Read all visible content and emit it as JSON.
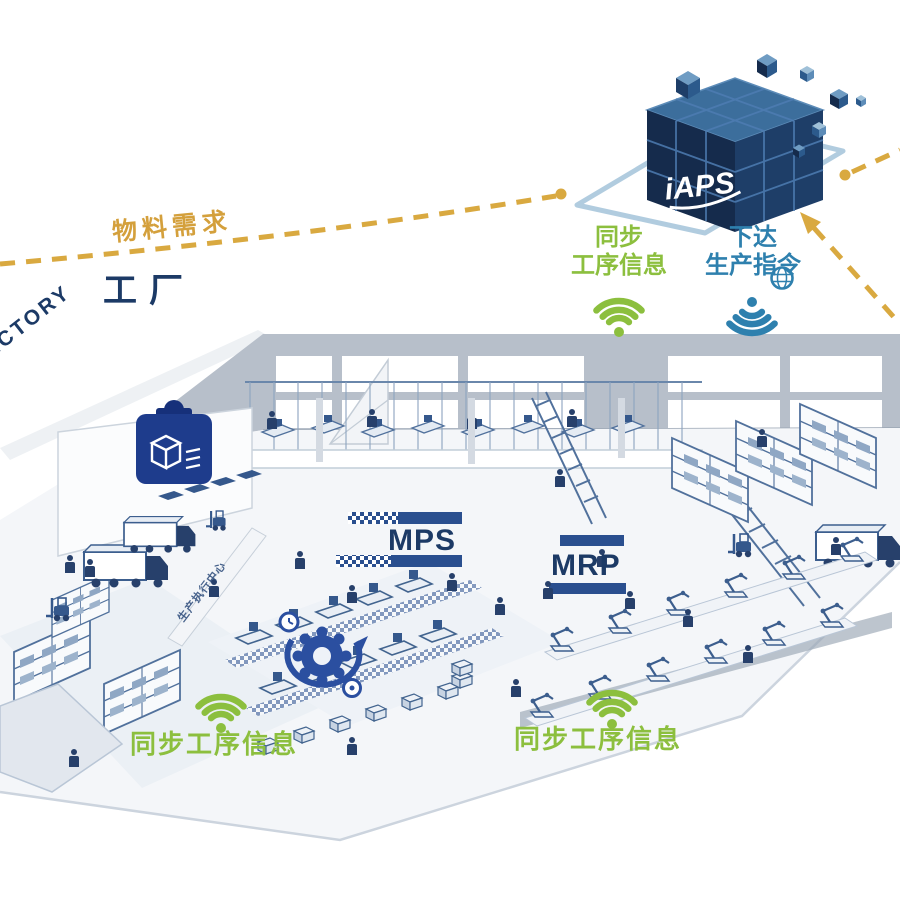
{
  "diagram": {
    "cube_logo": "iAPS",
    "material_demand": "物料需求",
    "factory_cn": "工厂",
    "factory_en": "FACTORY",
    "sync_process_top": {
      "line1": "同步",
      "line2": "工序信息"
    },
    "issue_instruction": {
      "line1": "下达",
      "line2": "生产指令"
    },
    "mps": "MPS",
    "mrp": "MRP",
    "sync_process_bottom_left": "同步工序信息",
    "sync_process_bottom_right": "同步工序信息",
    "wall_zone_text": "生产执行中心"
  },
  "icons": [
    "iaps-cube",
    "wifi-up-icon",
    "wifi-down-icon",
    "clipboard-box-icon",
    "gear-cycle-icon",
    "globe-icon",
    "dashed-arrow",
    "robot-arm",
    "shelf-rack",
    "truck",
    "forklift",
    "worker"
  ],
  "colors": {
    "gold": "#D4A03C",
    "green": "#8CBF3E",
    "blue": "#2E80AE",
    "navy_text": "#1C3A66",
    "royal_blue": "#1E3C8C",
    "bar_navy": "#2A4F8F",
    "wall_gray": "#B7BFCA",
    "line_blue": "#51719C",
    "cube_dark": "#152B4C",
    "cube_mid": "#1E3E68",
    "cube_top": "#3C6E9C",
    "platform_outline": "#A9C6DC"
  }
}
